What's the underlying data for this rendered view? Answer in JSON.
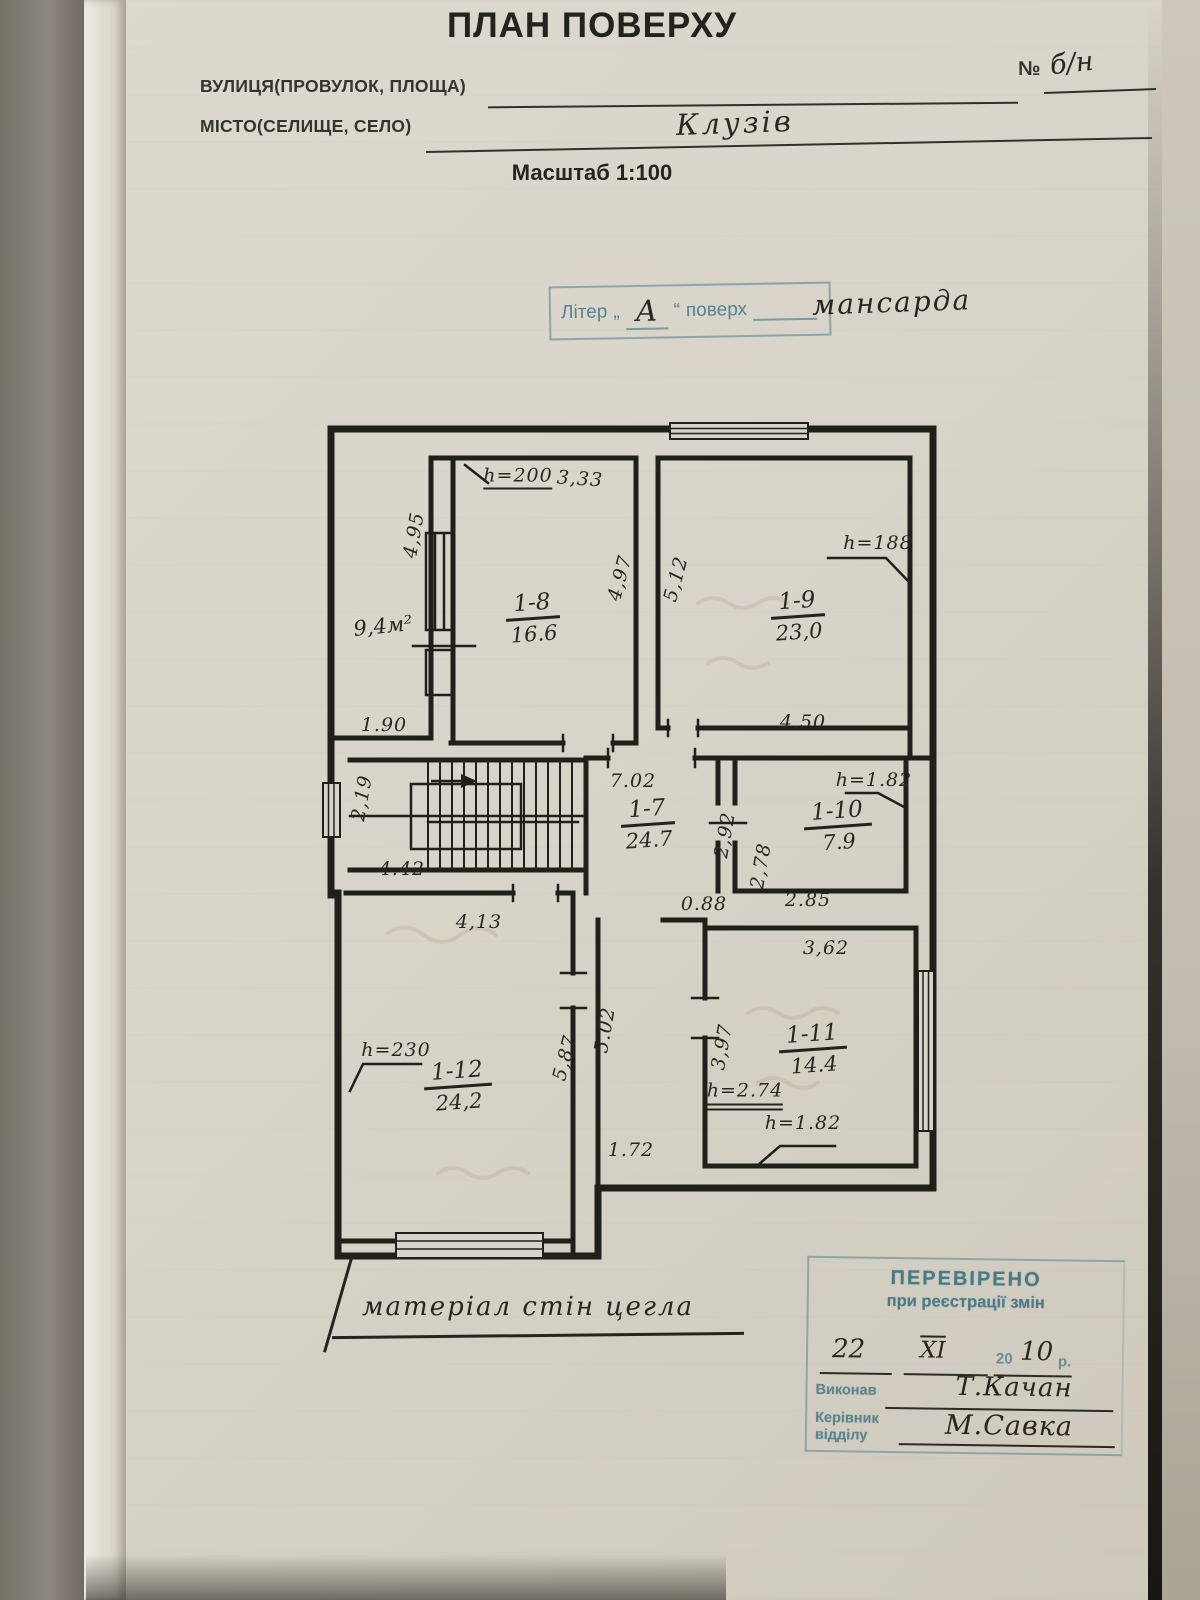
{
  "page": {
    "title": "ПЛАН ПОВЕРХУ",
    "scale_note": "Масштаб 1:100",
    "street_label": "ВУЛИЦЯ(ПРОВУЛОК, ПЛОЩА)",
    "street_value": "",
    "city_label": "МІСТО(СЕЛИЩЕ, СЕЛО)",
    "city_value": "Клузів",
    "number_label": "№",
    "number_value": "б/н"
  },
  "liter_stamp": {
    "word": "Літер",
    "open_quote": "„",
    "letter": "А",
    "close_quote": "“",
    "floor_word": "поверх",
    "floor_value": "мансарда"
  },
  "plan": {
    "material_note": "матеріал стін цегла",
    "rooms": [
      {
        "label": "9,4м²",
        "x": 65,
        "y": 213,
        "single": true
      },
      {
        "id": "1-8",
        "area": "16.6",
        "x": 215,
        "y": 205
      },
      {
        "id": "1-9",
        "area": "23,0",
        "x": 480,
        "y": 203
      },
      {
        "id": "1-7",
        "area": "24.7",
        "x": 330,
        "y": 411
      },
      {
        "id": "1-10",
        "area": "7.9",
        "x": 520,
        "y": 413
      },
      {
        "id": "1-11",
        "area": "14.4",
        "x": 495,
        "y": 636
      },
      {
        "id": "1-12",
        "area": "24,2",
        "x": 140,
        "y": 673
      }
    ],
    "dims": [
      {
        "t": "h=200",
        "x": 200,
        "y": 64,
        "u": 1
      },
      {
        "t": "3,33",
        "x": 262,
        "y": 66,
        "r": 4
      },
      {
        "t": "4,95",
        "x": 96,
        "y": 122,
        "r": -80
      },
      {
        "t": "1.90",
        "x": 66,
        "y": 312
      },
      {
        "t": "4,97",
        "x": 302,
        "y": 165,
        "r": -75
      },
      {
        "t": "5,12",
        "x": 358,
        "y": 166,
        "r": -75
      },
      {
        "t": "h=188",
        "x": 560,
        "y": 130
      },
      {
        "t": "4.50",
        "x": 485,
        "y": 309
      },
      {
        "t": "7.02",
        "x": 315,
        "y": 368
      },
      {
        "t": "2,19",
        "x": 44,
        "y": 385,
        "r": -80
      },
      {
        "t": "4.42",
        "x": 84,
        "y": 456
      },
      {
        "t": "2,92",
        "x": 407,
        "y": 422,
        "r": -80
      },
      {
        "t": "2,78",
        "x": 443,
        "y": 453,
        "r": -80
      },
      {
        "t": "h=1.82",
        "x": 556,
        "y": 367
      },
      {
        "t": "2.85",
        "x": 490,
        "y": 487
      },
      {
        "t": "0.88",
        "x": 386,
        "y": 491
      },
      {
        "t": "3,62",
        "x": 508,
        "y": 535
      },
      {
        "t": "3,97",
        "x": 404,
        "y": 634,
        "r": -80
      },
      {
        "t": "h=2.74",
        "x": 427,
        "y": 682,
        "u2": 1
      },
      {
        "t": "h=1.82",
        "x": 485,
        "y": 710
      },
      {
        "t": "4,13",
        "x": 161,
        "y": 509
      },
      {
        "t": "h=230",
        "x": 78,
        "y": 637
      },
      {
        "t": "5,87",
        "x": 247,
        "y": 645,
        "r": -75
      },
      {
        "t": "5.02",
        "x": 287,
        "y": 617,
        "r": -80
      },
      {
        "t": "1.72",
        "x": 313,
        "y": 737
      }
    ]
  },
  "verify_stamp": {
    "title": "ПЕРЕВІРЕНО",
    "subtitle": "при реєстрації змін",
    "day": "22",
    "month": "XI",
    "year_prefix": "20",
    "year_value": "10",
    "year_suffix": "р.",
    "executor_label": "Виконав",
    "executor_value": "Т.Качан",
    "head_label_line1": "Керівник",
    "head_label_line2": "відділу",
    "head_value": "М.Савка"
  },
  "colors": {
    "stamp_teal": "#4a7f8e",
    "ink": "#24221c",
    "paper": "#d8d4c9"
  }
}
